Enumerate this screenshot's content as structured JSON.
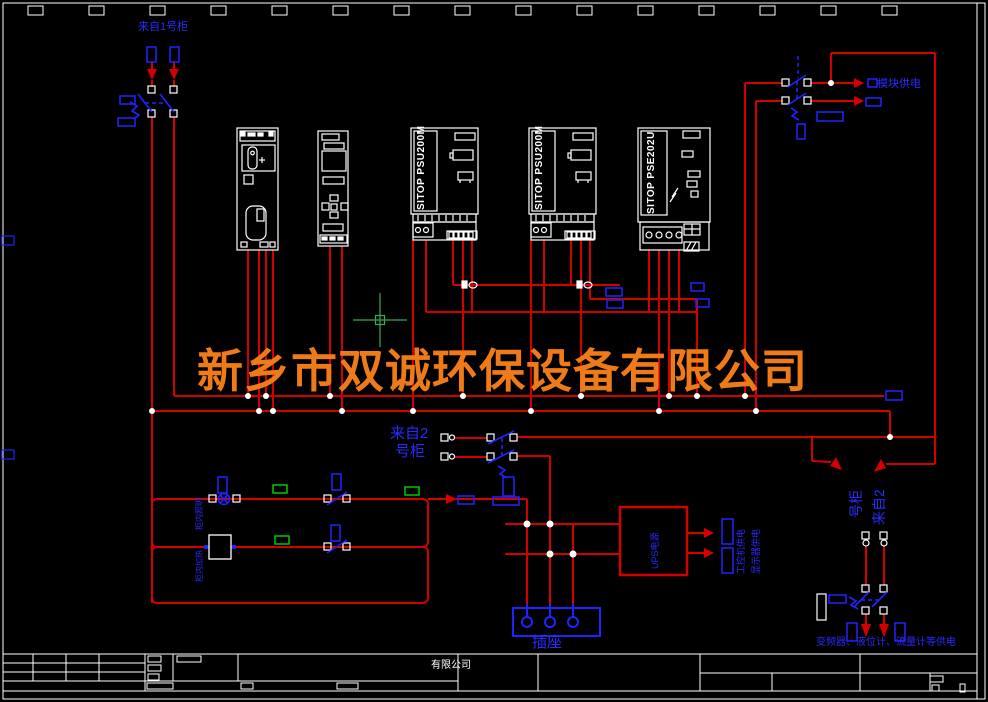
{
  "colors": {
    "background": "#000000",
    "wire_red": "#d40000",
    "component_blue": "#2222ff",
    "line_white": "#ffffff",
    "tag_green": "#00c800",
    "watermark_orange": "#ee7a18",
    "cursor_green": "#2fae54"
  },
  "drawing": {
    "watermark": "新乡市双诚环保设备有限公司",
    "devices": {
      "psu1": "SITOP PSU200M",
      "psu2": "SITOP PSU200M",
      "pse": "SITOP PSE202U"
    },
    "labels": {
      "from_cabinet1": "来自1号柜",
      "from_cabinet2_mid_1": "来自2",
      "from_cabinet2_mid_2": "号柜",
      "from_cabinet2_right_1": "来自2",
      "from_cabinet2_right_2": "号柜",
      "module_power": "模块供电",
      "socket": "插座",
      "ups_box": "UPS电源",
      "ups_out_1": "工控机供电",
      "ups_out_2": "显示器供电",
      "cabinet_lighting": "柜内照明",
      "cabinet_heater": "柜内加热",
      "right_loads": "变频器、液位计、流量计等供电",
      "company_short": "有限公司"
    }
  }
}
